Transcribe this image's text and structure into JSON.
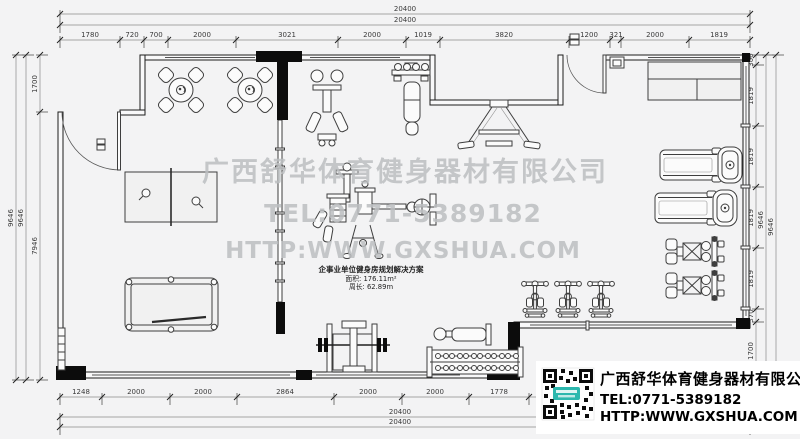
{
  "dims": {
    "top_totals": [
      "20400",
      "20400"
    ],
    "top": [
      "1780",
      "720",
      "700",
      "2000",
      "3021",
      "2000",
      "1019",
      "3820",
      "1200",
      "321",
      "2000",
      "1819"
    ],
    "left_totals": [
      "9646",
      "9646"
    ],
    "left": [
      "1700",
      "7946"
    ],
    "right": [
      "300",
      "1819",
      "1819",
      "1819",
      "1819",
      "370",
      "1700"
    ],
    "right_totals": [
      "9646",
      "9646"
    ],
    "bottom": [
      "1248",
      "2000",
      "2000",
      "2864",
      "2000",
      "2000",
      "1778"
    ],
    "bottom_totals": [
      "20400",
      "20400"
    ]
  },
  "watermark": {
    "company": "广西舒华体育健身器材有限公司",
    "tel": "TEL:0771-5389182",
    "web": "HTTP:WWW.GXSHUA.COM"
  },
  "plan_label": {
    "title": "企事业单位健身房规划解决方案",
    "area": "面积: 176.11m²",
    "perimeter": "周长: 62.89m"
  },
  "logo_card": {
    "company": "广西舒华体育健身器材有限公司",
    "tel": "TEL:0771-5389182",
    "web": "HTTP:WWW.GXSHUA.COM"
  },
  "colors": {
    "background": "#f3f3f4",
    "wall_line": "#1c1c1c",
    "dim_text": "#3a3a3a",
    "watermark": "#bcbfc1",
    "qr_badge_teal": "#2cb8ae",
    "card_bg": "#ffffff"
  }
}
